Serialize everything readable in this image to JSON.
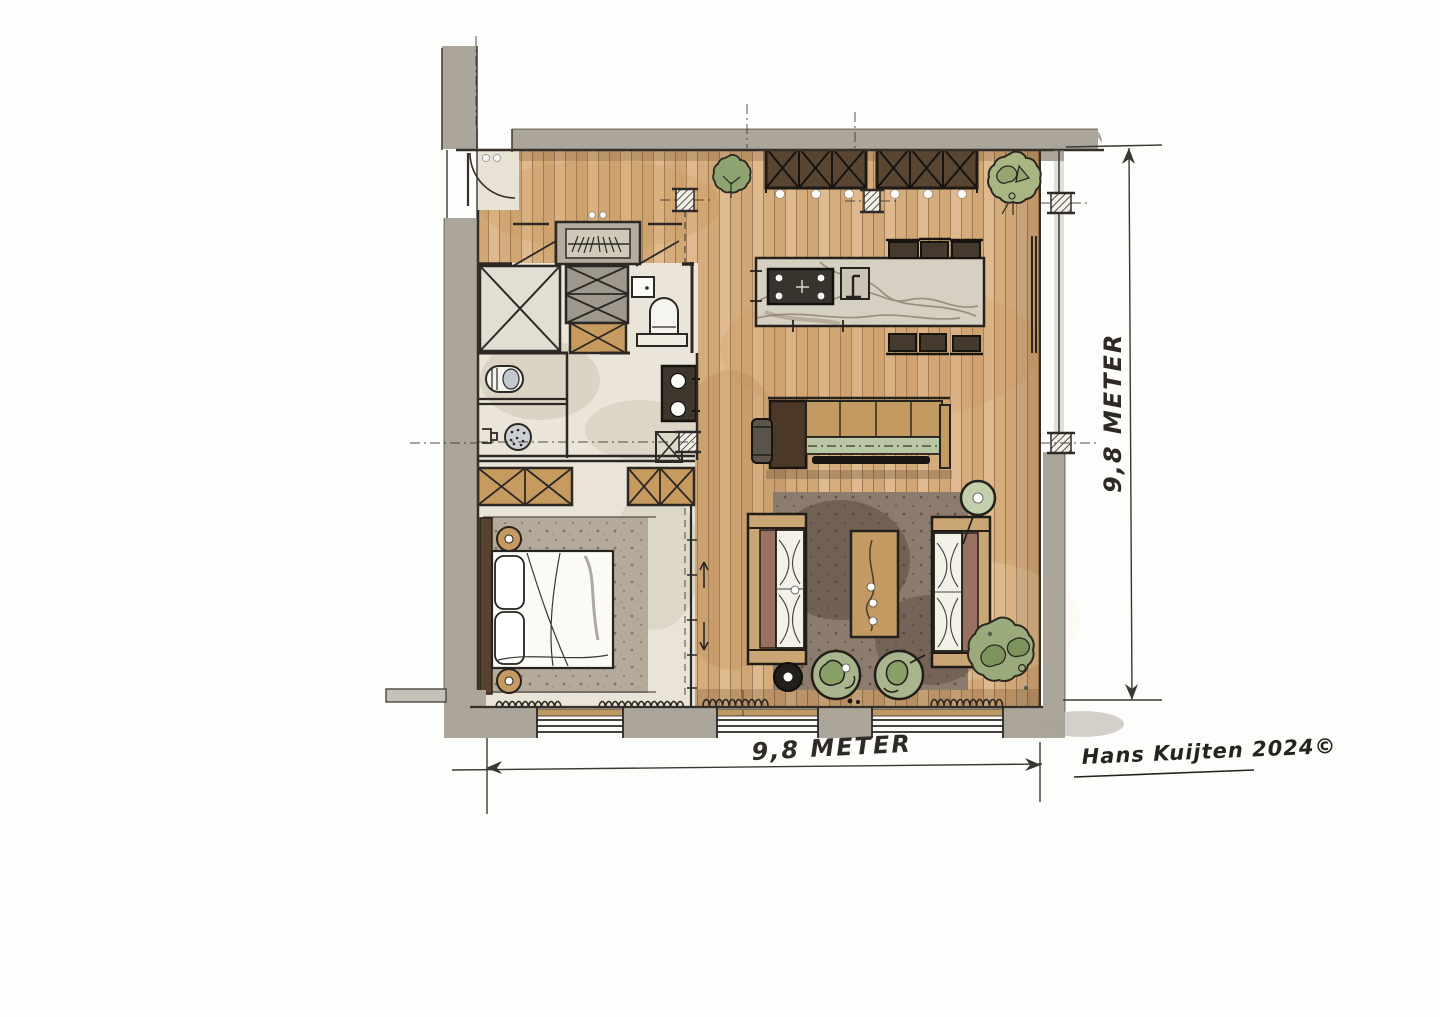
{
  "annotations": {
    "dimension_bottom_label": "9,8 METER",
    "dimension_right_label": "9,8 METER",
    "signature": "Hans Kuijten 2024©"
  },
  "palette": {
    "paper": "#fdfdfb",
    "wall_gray": "#aba59a",
    "wood_base": "#d8b184",
    "plank_line": "#6d4a2a",
    "cream_floor": "#eae5d8",
    "dark_cabinet": "#5a4533",
    "tan_cabinet": "#c79a60",
    "marble": "#d5d0c2",
    "cooktop": "#37332d",
    "rug_living": "#8b7c6d",
    "rug_bedroom": "#b5a99a",
    "sofa_cushion": "#f4f1e9",
    "sofa_back": "#9a7060",
    "shelf_green": "#b9c7a3",
    "plant_green": "#9aaa7b",
    "chair_green": "#a9b58c",
    "ink": "#2c2824"
  }
}
